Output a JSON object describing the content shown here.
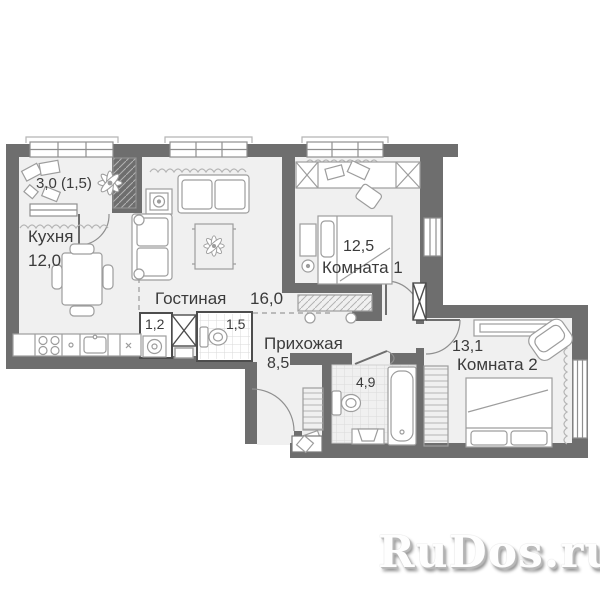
{
  "plan_title": "apartment-floor-plan",
  "rooms": {
    "balcony": {
      "label": "3,0 (1,5)"
    },
    "kitchen": {
      "name": "Кухня",
      "area": "12,0"
    },
    "living": {
      "name": "Гостиная",
      "area": "16,0"
    },
    "room1": {
      "name": "Комната 1",
      "area": "12,5"
    },
    "room2": {
      "name": "Комната 2",
      "area": "13,1"
    },
    "hallway": {
      "name": "Прихожая",
      "area": "8,5"
    },
    "bathroom": {
      "area": "4,9"
    },
    "wc": {
      "area": "1,5"
    },
    "laundry": {
      "area": "1,2"
    }
  },
  "watermark": {
    "text": "RuDos.ru"
  },
  "colors": {
    "wall": "#6e6e6e",
    "floor": "#f0f0f0",
    "furniture_line": "#9d9d9d",
    "text": "#3b3b3b",
    "watermark_shadow": "#888888"
  }
}
